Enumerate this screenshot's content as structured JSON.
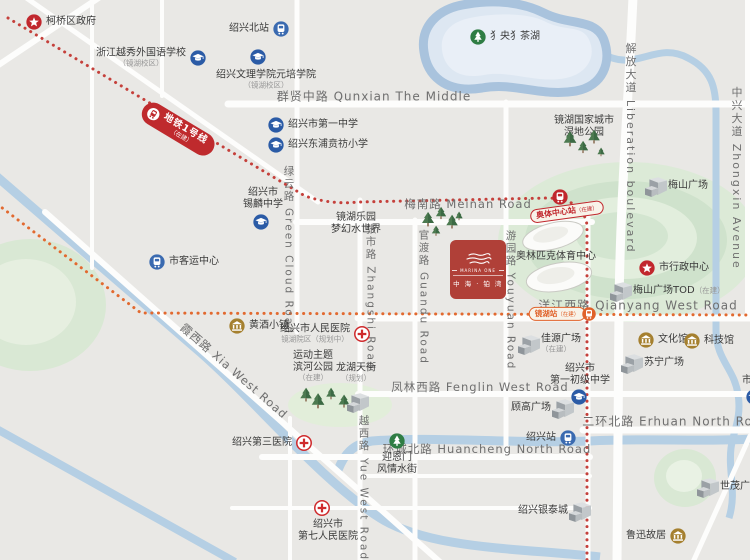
{
  "logo": {
    "en": "MARINA ONE",
    "cn": "中 海 · 铂 湾"
  },
  "metro": {
    "line1": {
      "label": "地铁1号线",
      "sub": "（在建）"
    },
    "stations": [
      {
        "id": "aoti",
        "label": "奥体中心站",
        "sub": "（在建）"
      },
      {
        "id": "jinghu",
        "label": "镜湖站",
        "sub": "（在建）"
      }
    ]
  },
  "roads": [
    {
      "t": "群贤中路 Qunxian The Middle",
      "x": 374,
      "y": 96,
      "size": 12
    },
    {
      "t": "梅南路 Meinan Road",
      "x": 468,
      "y": 204,
      "size": 11.5
    },
    {
      "t": "洋江西路 Qianyang West Road",
      "x": 638,
      "y": 305,
      "size": 12
    },
    {
      "t": "凤林西路 Fenglin West Road",
      "x": 480,
      "y": 387,
      "size": 11.5
    },
    {
      "t": "二环北路 Erhuan North Road",
      "x": 676,
      "y": 421,
      "size": 12
    },
    {
      "t": "环城北路 Huancheng North Road",
      "x": 487,
      "y": 449,
      "size": 11.5
    },
    {
      "t": "霞西路 Xia West Road",
      "x": 234,
      "y": 371,
      "size": 11.5,
      "rot": 41
    },
    {
      "t": "绿云路 Green Cloud Road",
      "x": 289,
      "y": 250,
      "size": 10.5,
      "v": 1
    },
    {
      "t": "张市路 Zhangshi Road",
      "x": 371,
      "y": 297,
      "size": 10.5,
      "v": 1
    },
    {
      "t": "官渡路 Guandu Road",
      "x": 424,
      "y": 297,
      "size": 10.5,
      "v": 1
    },
    {
      "t": "游园路 Youyuan Road",
      "x": 511,
      "y": 300,
      "size": 10.5,
      "v": 1
    },
    {
      "t": "越西路 Yue West Road",
      "x": 364,
      "y": 488,
      "size": 10.5,
      "v": 1
    },
    {
      "t": "解放大道 Liberation boulevard",
      "x": 630,
      "y": 148,
      "size": 11,
      "v": 1
    },
    {
      "t": "中兴大道 Zhongxin Avenue",
      "x": 736,
      "y": 178,
      "size": 11,
      "v": 1
    }
  ],
  "pois": [
    {
      "id": "keqiao-government",
      "icon": "star",
      "x": 34,
      "y": 22,
      "label": "柯桥区政府",
      "align": "right"
    },
    {
      "id": "yuexiu-school",
      "icon": "school",
      "x": 198,
      "y": 58,
      "label": "浙江越秀外国语学校",
      "sub": "（镜湖校区）",
      "align": "left"
    },
    {
      "id": "shaoxing-north-sta",
      "icon": "metro",
      "x": 281,
      "y": 29,
      "label": "绍兴北站",
      "align": "left"
    },
    {
      "id": "wenli-college",
      "icon": "school",
      "ix": 258,
      "iy": 57,
      "x": 266,
      "y": 80,
      "label": "绍兴文理学院元培学院",
      "sub": "（镜湖校区）",
      "align": "center"
    },
    {
      "id": "no1-middle-school",
      "icon": "school",
      "x": 276,
      "y": 125,
      "label": "绍兴市第一中学",
      "align": "right"
    },
    {
      "id": "dongpu-primary",
      "icon": "school",
      "x": 276,
      "y": 145,
      "label": "绍兴东浦贲祊小学",
      "align": "right"
    },
    {
      "id": "xilin-middle-school",
      "icon": "school",
      "ix": 261,
      "iy": 222,
      "x": 263,
      "y": 199,
      "lines": [
        "绍兴市",
        "锡麟中学"
      ],
      "align": "center"
    },
    {
      "id": "passenger-center",
      "icon": "metro",
      "x": 157,
      "y": 262,
      "label": "市客运中心",
      "align": "right"
    },
    {
      "id": "jinghu-waterpark",
      "x": 356,
      "y": 224,
      "lines": [
        "镜湖乐园",
        "梦幻水世界"
      ],
      "align": "center"
    },
    {
      "id": "angsang-lake",
      "icon": "treec",
      "x": 478,
      "y": 37,
      "label": "犭央犭茶湖",
      "align": "right"
    },
    {
      "id": "wetland-park",
      "x": 584,
      "y": 127,
      "lines": [
        "镜湖国家城市",
        "湿地公园"
      ],
      "align": "center"
    },
    {
      "id": "meishan-plaza",
      "icon": "building",
      "x": 656,
      "y": 186,
      "label": "梅山广场",
      "align": "right"
    },
    {
      "id": "admin-center",
      "icon": "star",
      "x": 647,
      "y": 268,
      "label": "市行政中心",
      "align": "right"
    },
    {
      "id": "meishan-tod",
      "icon": "building",
      "x": 621,
      "y": 291,
      "label": "梅山广场TOD",
      "sub": "（在建）",
      "sub_pos": "inline",
      "align": "right"
    },
    {
      "id": "olympic-center",
      "x": 556,
      "y": 257,
      "label": "奥林匹克体育中心",
      "align": "center"
    },
    {
      "id": "huangjiu-town",
      "icon": "bank",
      "x": 237,
      "y": 326,
      "label": "黄酒小镇",
      "align": "right"
    },
    {
      "id": "renmin-hospital",
      "icon": "hospital",
      "x": 362,
      "y": 334,
      "label": "绍兴市人民医院",
      "sub": "镜湖院区（规划中）",
      "align": "left"
    },
    {
      "id": "sports-river-park",
      "x": 313,
      "y": 366,
      "lines": [
        "运动主题",
        "滨河公园"
      ],
      "sub": "（在建）",
      "align": "center"
    },
    {
      "id": "longhu-tianjie",
      "x": 356,
      "y": 373,
      "label": "龙湖天街",
      "sub": "（规划）",
      "align": "center"
    },
    {
      "id": "jiayuan-plaza",
      "icon": "building",
      "x": 529,
      "y": 344,
      "label": "佳源广场",
      "sub": "（在建）",
      "align": "right"
    },
    {
      "id": "culture-hall",
      "icon": "bank",
      "x": 646,
      "y": 340,
      "label": "文化馆",
      "align": "right"
    },
    {
      "id": "science-hall",
      "icon": "bank",
      "x": 692,
      "y": 341,
      "label": "科技馆",
      "align": "right"
    },
    {
      "id": "suning-plaza",
      "icon": "building",
      "x": 632,
      "y": 363,
      "label": "苏宁广场",
      "align": "right"
    },
    {
      "id": "no1-junior-school",
      "icon": "school",
      "ix": 579,
      "iy": 397,
      "x": 580,
      "y": 375,
      "lines": [
        "绍兴市",
        "第一初级中学"
      ],
      "align": "center"
    },
    {
      "id": "gugao-plaza",
      "icon": "building",
      "x": 563,
      "y": 408,
      "label": "顾高广场",
      "align": "left"
    },
    {
      "id": "third-hospital",
      "icon": "hospital",
      "x": 304,
      "y": 443,
      "label": "绍兴第三医院",
      "align": "left"
    },
    {
      "id": "yingenmen-street",
      "icon": "treec",
      "x": 397,
      "y": 441,
      "lines": [
        "迎恩门",
        "风情水街"
      ],
      "align": "below"
    },
    {
      "id": "shaoxing-station",
      "icon": "metro",
      "x": 568,
      "y": 438,
      "label": "绍兴站",
      "align": "left"
    },
    {
      "id": "seventh-hospital",
      "icon": "hospital",
      "x": 322,
      "y": 508,
      "lx": 328,
      "lines": [
        "绍兴市",
        "第七人民医院"
      ],
      "align": "below"
    },
    {
      "id": "yintai-city",
      "icon": "building",
      "x": 580,
      "y": 511,
      "label": "绍兴银泰城",
      "align": "left"
    },
    {
      "id": "shimao-plaza",
      "icon": "building",
      "x": 708,
      "y": 487,
      "label": "世茂广场",
      "align": "right"
    },
    {
      "id": "luxun-residence",
      "icon": "bank",
      "x": 678,
      "y": 536,
      "label": "鲁迅故居",
      "align": "left"
    },
    {
      "id": "edge-partial",
      "icon": "school",
      "ix": 754,
      "iy": 397,
      "x": 747,
      "y": 381,
      "label": "市",
      "align": "center"
    }
  ],
  "decor": {
    "trees": [
      {
        "x": 570,
        "y": 152,
        "s": 1.05
      },
      {
        "x": 583,
        "y": 158,
        "s": 0.85
      },
      {
        "x": 594,
        "y": 149,
        "s": 0.95
      },
      {
        "x": 601,
        "y": 161,
        "s": 0.6
      },
      {
        "x": 428,
        "y": 232,
        "s": 1.0
      },
      {
        "x": 441,
        "y": 224,
        "s": 0.85
      },
      {
        "x": 452,
        "y": 234,
        "s": 0.95
      },
      {
        "x": 436,
        "y": 241,
        "s": 0.7
      },
      {
        "x": 459,
        "y": 225,
        "s": 0.6
      },
      {
        "x": 306,
        "y": 407,
        "s": 0.95
      },
      {
        "x": 318,
        "y": 414,
        "s": 1.05
      },
      {
        "x": 331,
        "y": 405,
        "s": 0.8
      },
      {
        "x": 344,
        "y": 413,
        "s": 0.9
      }
    ],
    "buildings": [
      {
        "x": 358,
        "y": 402
      }
    ]
  },
  "colors": {
    "background": "#e9e8e5",
    "water": "#b5cfe4",
    "brand_red": "#b04038",
    "metro_pill_red": "#bf2a2d",
    "metro_line_red": "#c5403b",
    "metro_line_orange": "#e2692f",
    "school_blue": "#2b5ba6",
    "transit_blue": "#3a6ab0",
    "poi_gold": "#a5802f",
    "park_green": "#2f7d44",
    "hospital_red": "#cf2b2d",
    "star_red": "#c1272d"
  },
  "icon_legend": {
    "star-icon": "government / civic center",
    "school-icon": "graduation cap school",
    "metro-icon": "train in circle station",
    "hospital-icon": "red cross",
    "bank-icon": "classical building culture poi",
    "tree-icon": "park / scenic spot",
    "building-icon": "isometric commercial plaza"
  }
}
